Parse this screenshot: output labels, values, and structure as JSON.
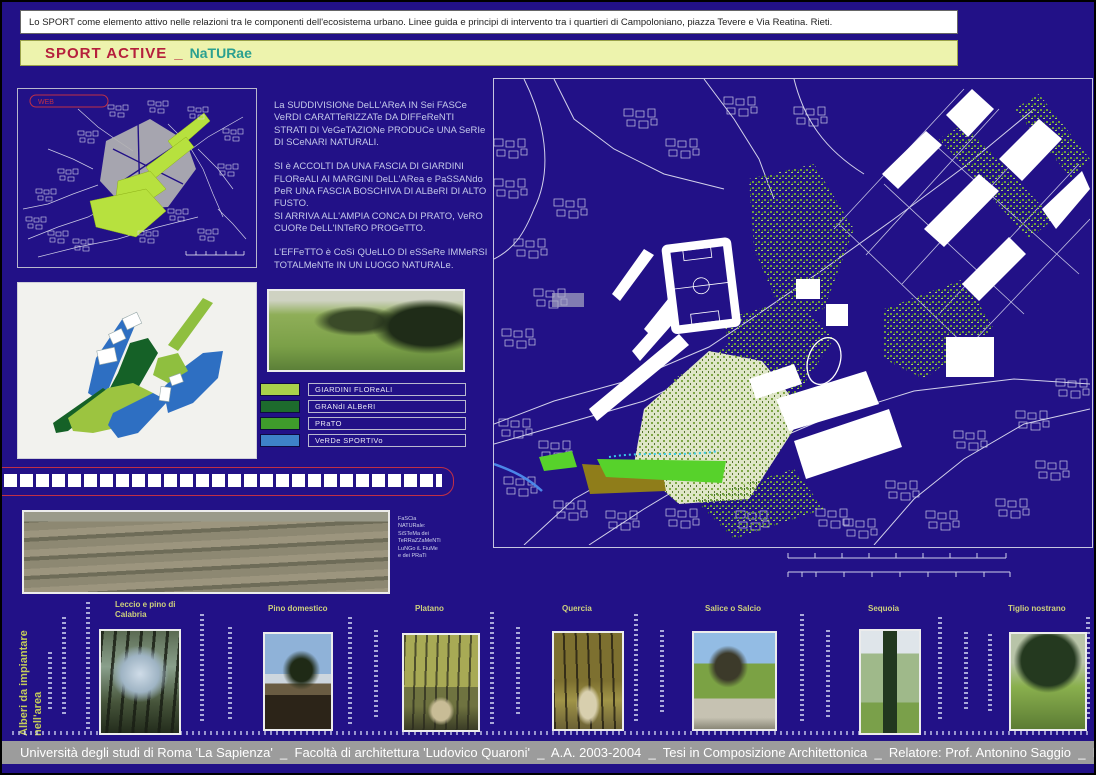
{
  "banner": {
    "text": "Lo SPORT come elemento attivo nelle relazioni tra le componenti dell'ecosistema urbano.  Linee guida e principi di intervento tra i quartieri di Campoloniano, piazza Tevere e Via Reatina. Rieti."
  },
  "title": {
    "main": "SPORT ACTIVE",
    "sep": "_",
    "accent": "NaTURae"
  },
  "overview_map": {
    "tag": "WEB"
  },
  "description": {
    "p1": "La SUDDIVISIONe DeLL'AReA IN Sei FASCe VeRDI CARATTeRIZZATe DA DIFFeReNTI STRATI DI VeGeTAZIONe PRODUCe UNA SeRIe DI SCeNARI NATURALI.",
    "p2": "SI è ACCOLTI  DA UNA FASCIA DI GIARDINI FLOReALI AI MARGINI DeLL'ARea e PaSSANdo PeR UNA FASCIA BOSCHIVA DI ALBeRI DI ALTO FUSTO.",
    "p3": "SI  ARRIVA ALL'AMPIA CONCA DI PRATO, VeRO CUORe DeLL'INTeRO PROGeTTO.",
    "p4": "L'EFFeTTO è CoSì QUeLLO DI eSSeRe IMMeRSI TOTALMeNTe IN UN LUOGO NATURALe."
  },
  "legend": {
    "items": [
      {
        "label": "GIARDINI FLOReALI",
        "color": "#a9d14b"
      },
      {
        "label": "GRANdI ALBeRI",
        "color": "#1d6b2d"
      },
      {
        "label": "PRaTO",
        "color": "#3f9c2b"
      },
      {
        "label": "VeRDe SPORTIVo",
        "color": "#3e82c8"
      }
    ]
  },
  "panorama_caption": {
    "l1": "FaSCia",
    "l2": "NATURale:",
    "l3": "SiSTeMa dei",
    "l4": "TeRRaZZaMeNTi",
    "l5": "LuNGo iL FiuMe",
    "l6": "e dei PRaTi"
  },
  "trees": {
    "section_label": "Alberi da impiantare nell'area",
    "items": [
      {
        "label": "Leccio e pino di\nCalabria"
      },
      {
        "label": "Pino domestico"
      },
      {
        "label": "Platano"
      },
      {
        "label": "Quercia"
      },
      {
        "label": "Salice o Salcio"
      },
      {
        "label": "Sequoia"
      },
      {
        "label": "Tiglio nostrano"
      }
    ]
  },
  "footer": {
    "text": "Università degli studi di Roma 'La Sapienza'  _  Facoltà di architettura 'Ludovico Quaroni'  _  A.A. 2003-2004  _  Tesi in Composizione Architettonica  _  Relatore: Prof. Antonino Saggio  _  Laureando: Virgilio D'Annibale"
  },
  "colors": {
    "page_bg": "#221187",
    "title_bg": "#edf3ad",
    "title_main": "#b5203c",
    "title_accent": "#2aa090",
    "footer_bg": "#9c9c9c",
    "highlight_green": "#b7e13e",
    "bright_green": "#57d22b",
    "olive": "#8f7d1a",
    "water_blue": "#4b86e8"
  }
}
